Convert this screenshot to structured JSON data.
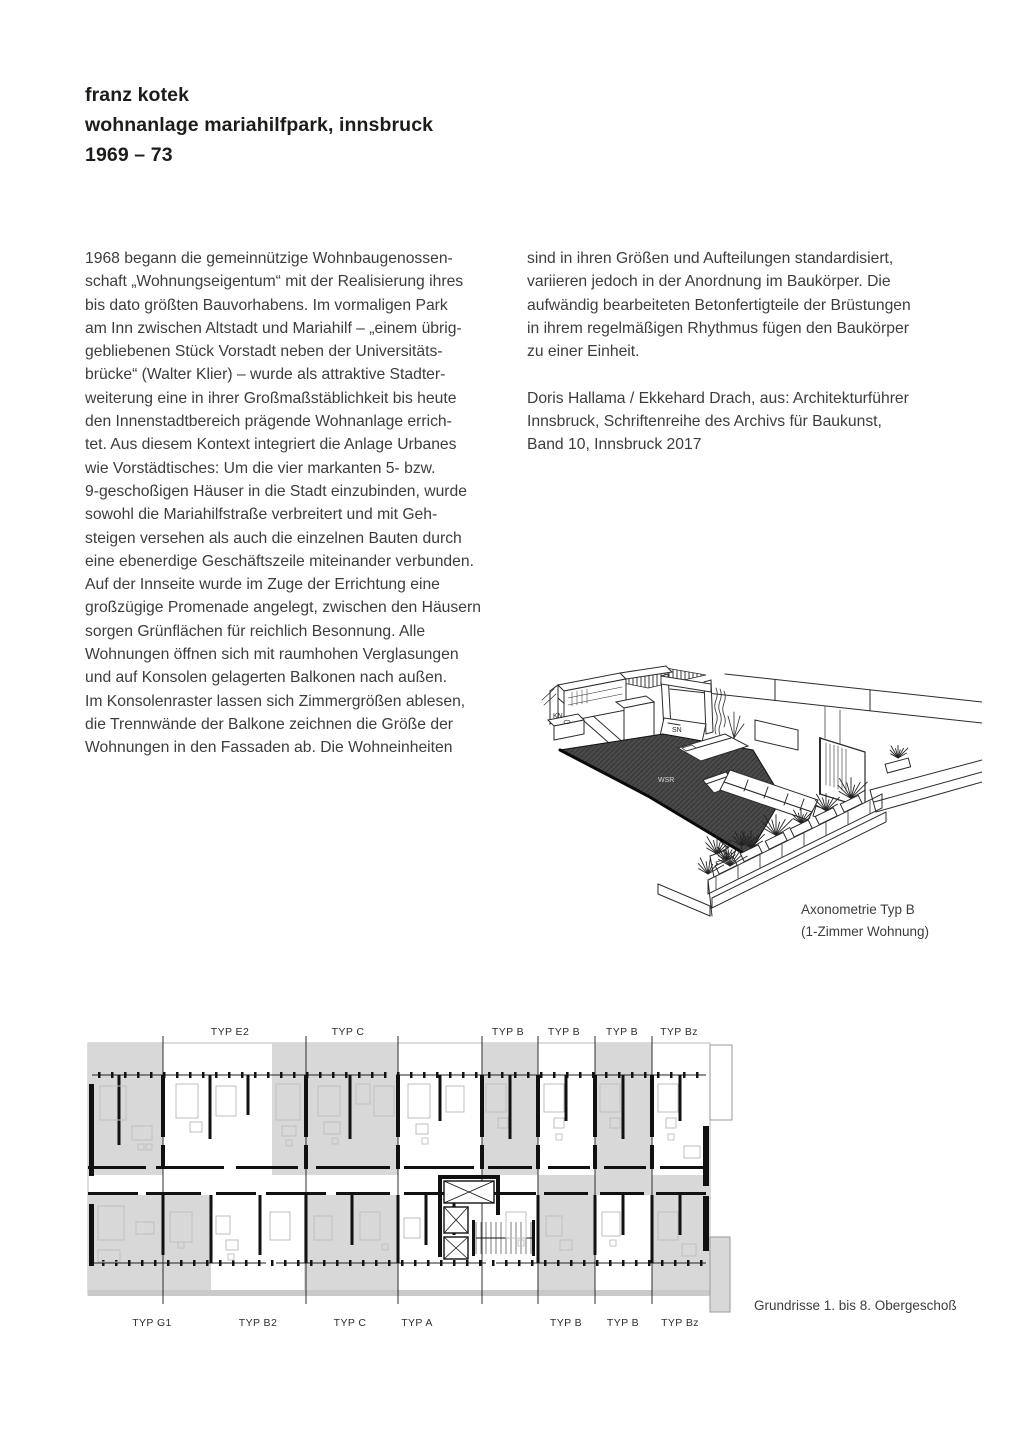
{
  "header": {
    "line1": "franz kotek",
    "line2": "wohnanlage mariahilfpark, innsbruck",
    "line3": "1969 – 73"
  },
  "article": {
    "left_column_lines": [
      "1968 begann die gemeinnützige Wohnbaugenossen-",
      "schaft „Wohnungseigentum“ mit der Realisierung ihres",
      "bis dato größten Bauvorhabens. Im vormaligen Park",
      "am Inn zwischen Altstadt und Mariahilf – „einem übrig-",
      "gebliebenen Stück Vorstadt neben der Universitäts-",
      "brücke“ (Walter Klier) – wurde als attraktive Stadter-",
      "weiterung eine in ihrer Großmaßstäblichkeit bis heute",
      "den Innenstadtbereich prägende Wohnanlage errich-",
      "tet. Aus diesem Kontext integriert die Anlage Urbanes",
      "wie Vorstädtisches: Um die vier markanten 5- bzw.",
      "9-geschoßigen Häuser in die Stadt einzubinden, wurde",
      "sowohl die Mariahilfstraße verbreitert und mit Geh-",
      "steigen versehen als auch die einzelnen Bauten durch",
      "eine ebenerdige Geschäftszeile miteinander verbunden.",
      "Auf der Innseite wurde im Zuge der Errichtung eine",
      "großzügige Promenade angelegt, zwischen den Häusern",
      "sorgen Grünflächen für reichlich Besonnung. Alle",
      "Wohnungen öffnen sich mit raumhohen Verglasungen",
      "und auf Konsolen gelagerten Balkonen nach außen.",
      "Im Konsolenraster lassen sich Zimmergrößen ablesen,",
      "die Trennwände der Balkone zeichnen die Größe der",
      "Wohnungen in den Fassaden ab. Die Wohneinheiten"
    ],
    "right_column_lines": [
      "sind in ihren Größen und Aufteilungen standardisiert,",
      "variieren jedoch in der Anordnung im Baukörper. Die",
      "aufwändig bearbeiteten Betonfertigteile der Brüstungen",
      "in ihrem regelmäßigen Rhythmus fügen den Baukörper",
      "zu einer Einheit."
    ],
    "credit_lines": [
      "Doris Hallama / Ekkehard Drach, aus: Architekturführer",
      "Innsbruck, Schriftenreihe des Archivs für Baukunst,",
      "Band 10, Innsbruck 2017"
    ]
  },
  "axonometric": {
    "caption_line1": "Axonometrie Typ B",
    "caption_line2": "(1-Zimmer Wohnung)",
    "labels": {
      "kitchen": "KN",
      "sleeping": "SN",
      "living": "WSR"
    }
  },
  "floorplan": {
    "caption": "Grundrisse 1. bis 8. Obergeschoß",
    "labels_top": [
      "TYP E2",
      "TYP C",
      "TYP B",
      "TYP B",
      "TYP B",
      "TYP Bz"
    ],
    "labels_bottom": [
      "TYP G1",
      "TYP B2",
      "TYP C",
      "TYP A",
      "TYP B",
      "TYP B",
      "TYP Bz"
    ]
  },
  "colors": {
    "text": "#3d3d3d",
    "title": "#1c1c1a",
    "ink": "#111111",
    "plan_shading": "#d8d8d8",
    "furniture_line": "#bfbfbf",
    "floor_dark": "#4a4a4a"
  }
}
